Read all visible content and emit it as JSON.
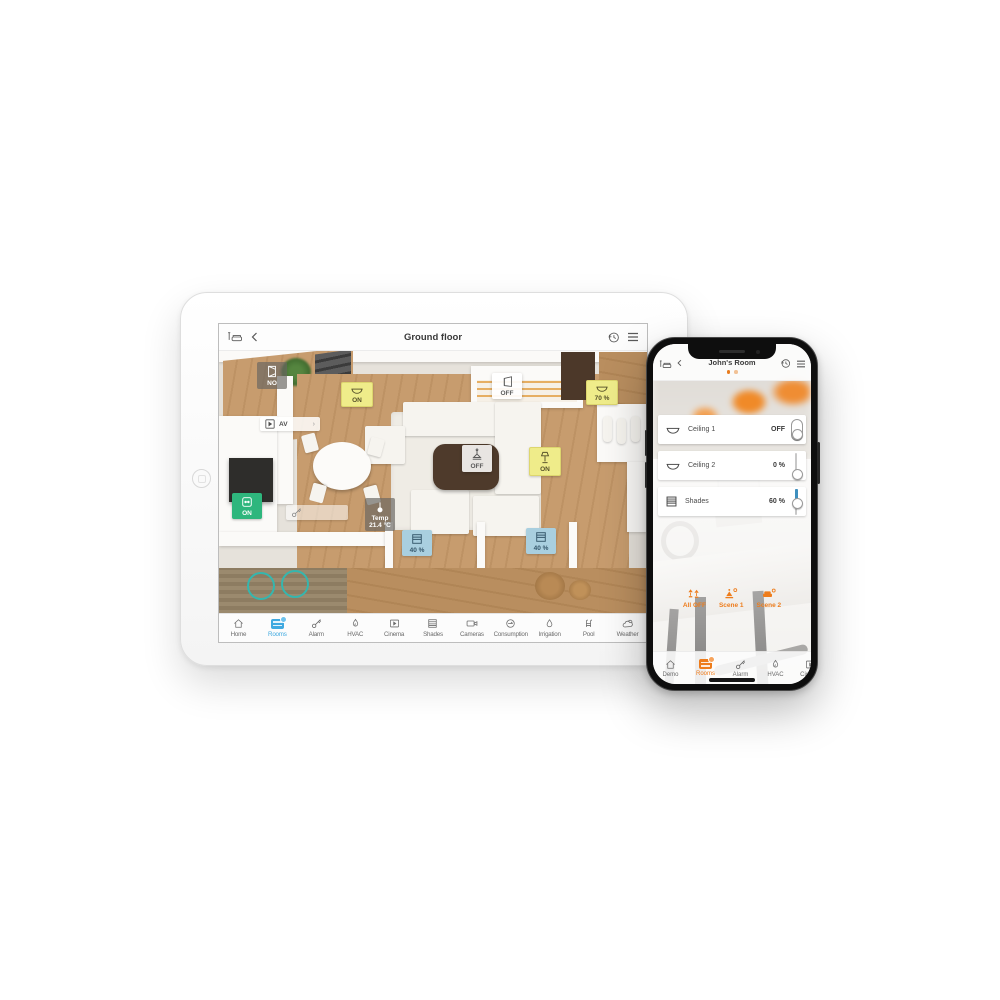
{
  "tablet": {
    "header": {
      "title": "Ground floor",
      "left_icon": "room-sofa-icon",
      "back_icon": "chevron-left-icon",
      "history_icon": "history-clock-icon",
      "menu_icon": "hamburger-menu-icon"
    },
    "badges": [
      {
        "label": "NO",
        "icon": "window-icon",
        "style": "gray"
      },
      {
        "label": "ON",
        "icon": "ceiling-light-icon",
        "style": "yellow"
      },
      {
        "label": "OFF",
        "icon": "door-icon",
        "style": "white"
      },
      {
        "label": "70 %",
        "icon": "ceiling-light-icon",
        "style": "yellow"
      },
      {
        "label": "AV",
        "icon": "play-icon",
        "style": "pill"
      },
      {
        "label": "OFF",
        "icon": "pendant-light-icon",
        "style": "white"
      },
      {
        "label": "ON",
        "icon": "floor-lamp-icon",
        "style": "yellow"
      },
      {
        "label": "ON",
        "icon": "socket-icon",
        "style": "green"
      },
      {
        "label": "Temp",
        "label2": "21.4 °C",
        "icon": "thermometer-icon",
        "style": "gray"
      },
      {
        "label": "40 %",
        "icon": "shades-icon",
        "style": "blue"
      },
      {
        "label": "40 %",
        "icon": "shades-icon",
        "style": "blue"
      },
      {
        "label": "",
        "icon": "key-icon",
        "style": "pill"
      }
    ],
    "tabbar": [
      {
        "label": "Home",
        "icon": "home-icon",
        "active": false
      },
      {
        "label": "Rooms",
        "icon": "rooms-icon",
        "active": true
      },
      {
        "label": "Alarm",
        "icon": "key-icon",
        "active": false
      },
      {
        "label": "HVAC",
        "icon": "flame-icon",
        "active": false
      },
      {
        "label": "Cinema",
        "icon": "cinema-icon",
        "active": false
      },
      {
        "label": "Shades",
        "icon": "shades-icon",
        "active": false
      },
      {
        "label": "Cameras",
        "icon": "camera-icon",
        "active": false
      },
      {
        "label": "Consumption",
        "icon": "meter-icon",
        "active": false
      },
      {
        "label": "Irrigation",
        "icon": "droplet-icon",
        "active": false
      },
      {
        "label": "Pool",
        "icon": "pool-ladder-icon",
        "active": false
      },
      {
        "label": "Weather",
        "icon": "weather-icon",
        "active": false
      }
    ]
  },
  "phone": {
    "header": {
      "title": "John's Room",
      "page_dots": 2
    },
    "controls": [
      {
        "name": "Ceiling 1",
        "value": "OFF",
        "icon": "ceiling-light-icon",
        "control": "toggle",
        "percent": 0
      },
      {
        "name": "Ceiling 2",
        "value": "0 %",
        "icon": "ceiling-light-icon",
        "control": "slider",
        "percent": 0
      },
      {
        "name": "Shades",
        "value": "60 %",
        "icon": "shades-icon",
        "control": "slider",
        "percent": 60
      }
    ],
    "scenes": [
      {
        "label": "All OFF",
        "icon": "lamps-off-icon"
      },
      {
        "label": "Scene 1",
        "icon": "scene-gear-icon"
      },
      {
        "label": "Scene 2",
        "icon": "sofa-gear-icon"
      }
    ],
    "tabbar": [
      {
        "label": "Demo",
        "icon": "home-icon",
        "active": false
      },
      {
        "label": "Rooms",
        "icon": "rooms-icon",
        "active": true
      },
      {
        "label": "Alarm",
        "icon": "key-icon",
        "active": false
      },
      {
        "label": "HVAC",
        "icon": "flame-icon",
        "active": false
      },
      {
        "label": "Cinema",
        "icon": "cinema-icon",
        "active": false
      }
    ]
  },
  "colors": {
    "tablet_accent": "#3fa9e0",
    "phone_accent": "#ee7c1b",
    "badge_yellow": "#efec8a",
    "badge_green": "#2eb67d",
    "badge_blue": "#a9cfdf",
    "slider_blue": "#3e8fbe"
  }
}
